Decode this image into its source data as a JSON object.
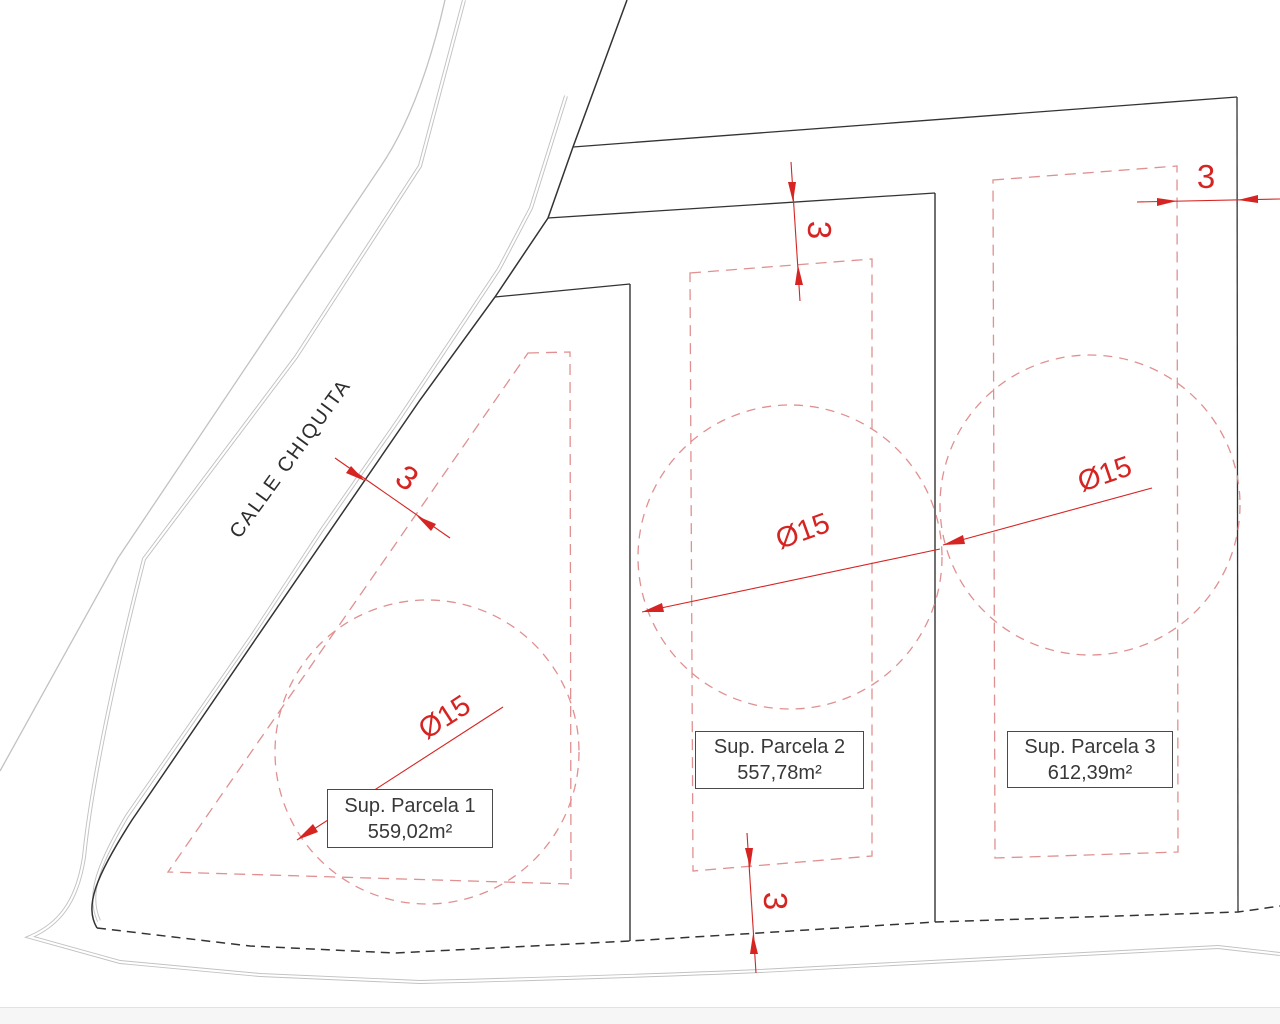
{
  "street": {
    "label": "CALLE CHIQUITA"
  },
  "parcels": [
    {
      "label": "Sup. Parcela 1",
      "area": "559,02m²",
      "diameter": "Ø15"
    },
    {
      "label": "Sup. Parcela 2",
      "area": "557,78m²",
      "diameter": "Ø15"
    },
    {
      "label": "Sup. Parcela 3",
      "area": "612,39m²",
      "diameter": "Ø15"
    }
  ],
  "setback_dims": {
    "road": "3",
    "top": "3",
    "right": "3",
    "bottom": "3"
  },
  "colors": {
    "annotation_red": "#d62422",
    "setback_dashed_red": "#e09090",
    "boundary_black": "#333333",
    "road_gray": "#c2c2c2"
  }
}
